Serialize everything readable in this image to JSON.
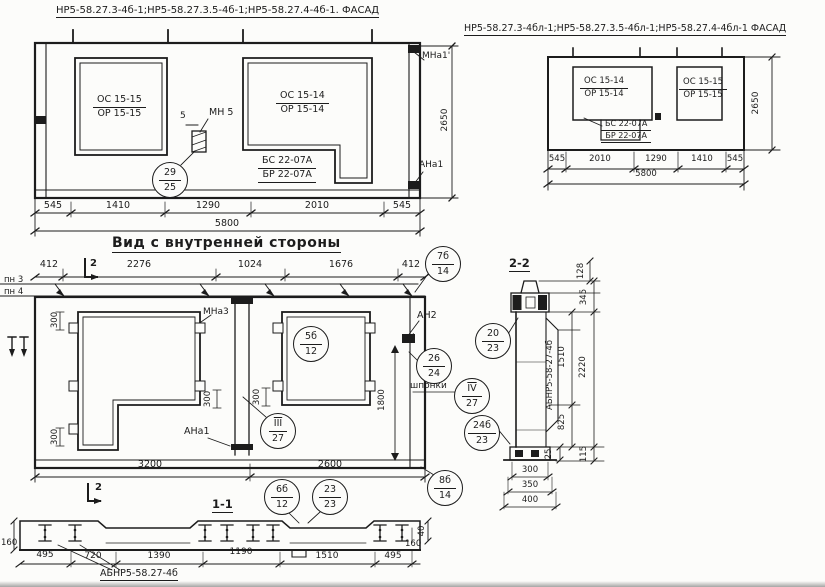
{
  "drawing": {
    "fl": {
      "title": "НР5-58.27.3-4б-1;НР5-58.27.3.5-4б-1;НР5-58.27.4-4б-1. ФАСАД",
      "win1_top": "ОС 15-15",
      "win1_bot": "ОР 15-15",
      "win2_top": "ОС 15-14",
      "win2_bot": "ОР 15-14",
      "beam_top": "БС 22-07А",
      "beam_bot": "БР 22-07А",
      "mn5": "МН 5",
      "dim5": "5",
      "c29_top": "29",
      "c29_bot": "25",
      "mna1": "МНа1'",
      "ana1": "АНа1",
      "h": "2650",
      "dims": [
        "545",
        "1410",
        "1290",
        "2010",
        "545"
      ],
      "total": "5800"
    },
    "fr": {
      "title": "НР5-58.27.3-4бл-1;НР5-58.27.3.5-4бл-1;НР5-58.27.4-4бл-1 ФАСАД",
      "win1_top": "ОС 15-14",
      "win1_bot": "ОР 15-14",
      "beam_top": "БС 22-07А",
      "beam_bot": "БР 22-07А",
      "win2_top": "ОС 15-15",
      "win2_bot": "ОР 15-15",
      "h": "2650",
      "dims": [
        "545",
        "2010",
        "1290",
        "1410",
        "545"
      ],
      "total": "5800"
    },
    "iv": {
      "title": "Вид с внутренней стороны",
      "top_dims": [
        "412",
        "2276",
        "1024",
        "1676",
        "412"
      ],
      "pn3": "пн 3",
      "pn4": "пн 4",
      "sec2": "2",
      "mna3": "МНа3",
      "ana1": "АНа1",
      "an2": "АН2",
      "shponki": "шпонки",
      "d300": "300",
      "d1800": "1800",
      "c7b_top": "7б",
      "c7b_bot": "14",
      "c5b_top": "5б",
      "c5b_bot": "12",
      "c26_top": "26",
      "c26_bot": "24",
      "cIV_top": "IV",
      "cIV_bot": "27",
      "cIII_top": "III",
      "cIII_bot": "27",
      "c6b_top": "6б",
      "c6b_bot": "12",
      "c23_top": "23",
      "c23_bot": "23",
      "c8b_top": "8б",
      "c8b_bot": "14",
      "d3200": "3200",
      "d2600": "2600"
    },
    "s22": {
      "title": "2-2",
      "mark": "АБНР5-58-27-4б",
      "c20_top": "20",
      "c20_bot": "23",
      "c24_top": "24б",
      "c24_bot": "23",
      "d128": "128",
      "d345": "345",
      "d1510": "1510",
      "d2220": "2220",
      "d825": "825",
      "d25": "25",
      "d115": "115",
      "w300": "300",
      "w350": "350",
      "w400": "400"
    },
    "s11": {
      "title": "1-1",
      "mark": "АБНР5-58.27-4б",
      "l160": "160",
      "d495a": "495",
      "d720": "720",
      "d1390": "1390",
      "d1190": "1190",
      "d1510": "1510",
      "d495b": "495",
      "d40": "40",
      "r160": "160"
    }
  }
}
